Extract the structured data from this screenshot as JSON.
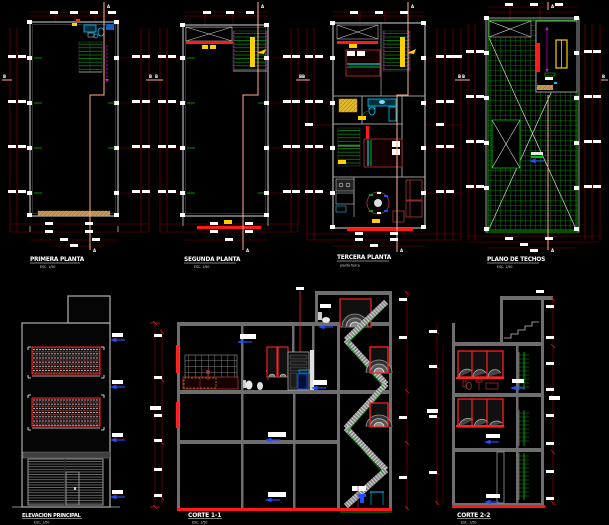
{
  "drawing": {
    "plans": [
      {
        "title": "PRIMERA PLANTA",
        "scale": "ESC. 1/50"
      },
      {
        "title": "SEGUNDA PLANTA",
        "scale": "ESC. 1/50"
      },
      {
        "title": "TERCERA PLANTA",
        "scale": "planta tipica"
      },
      {
        "title": "PLANO DE TECHOS",
        "scale": "ESC. 1/50"
      }
    ],
    "sections": [
      {
        "title": "ELEVACION PRINCIPAL",
        "scale": "ESC. 1/50"
      },
      {
        "title": "CORTE 1-1",
        "scale": "ESC. 1/50"
      },
      {
        "title": "CORTE 2-2",
        "scale": "ESC. 1/50"
      }
    ],
    "markers": {
      "a": "A",
      "b": "B"
    }
  },
  "colors": {
    "background": "#000000",
    "dimension_line": "#8b0000",
    "wall_gray": "#9a9a9a",
    "accent_red": "#ff1a1a",
    "stair_green": "#00a000",
    "fixture_cyan": "#00c8ff",
    "highlight_yellow": "#ffd000",
    "section_cut_salmon": "#ffb08a",
    "marker_magenta": "#ff00ff",
    "level_arrow_blue": "#2050ff",
    "furniture_darkred": "#b03535"
  }
}
